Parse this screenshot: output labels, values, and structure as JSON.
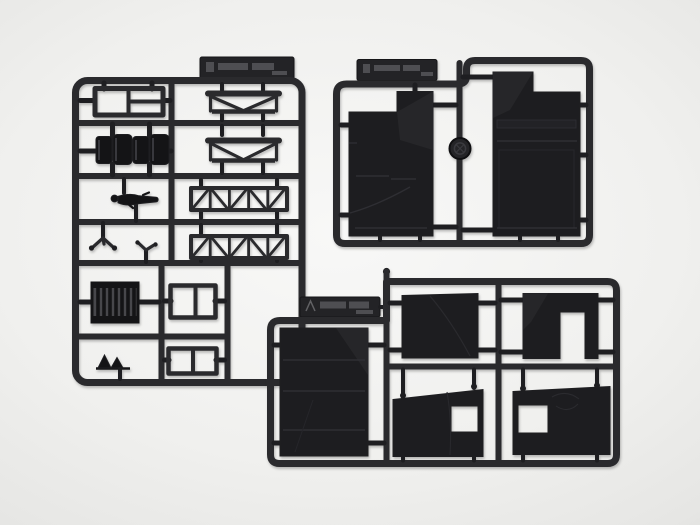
{
  "scene": {
    "alt": "Photograph of three black injection-molded plastic model kit sprues (part trees) laid on a light gray studio background",
    "background": "light gray seamless backdrop, soft vignette"
  },
  "colors": {
    "bg_center": "#f8f8f7",
    "bg_mid": "#f0f0ee",
    "bg_outer": "#e6e6e4",
    "bg_corner": "#dededc",
    "runner": "#2a2a2d",
    "runner_dark": "#1e1e21",
    "plastic": "#1d1d20",
    "plastic_part": "#141416",
    "plastic_seam": "#313135",
    "slat_gap": "#47474b",
    "tag": "#232326",
    "emboss": "#8a8a8e"
  },
  "sprues": [
    {
      "name": "sprue-a-detail-parts",
      "alt": "Small-parts sprue: three-pane window frame, two bench seats, prone crew figure, two mirror arms, radiator grille, two roof trusses, two X-braced girder trusses, two twin window frames and terrain wedges",
      "tag_note": "molded maker tag, embossed illegible lettering"
    },
    {
      "name": "sprue-b-large-panels",
      "alt": "Sprue with two large flat body side panels, a round hub cap on the center runner and a molded maker tag",
      "tag_note": "molded maker tag, embossed illegible lettering"
    },
    {
      "name": "sprue-c-wall-panels",
      "alt": "Sprue with a large wall panel, a plain rectangular panel, an inverted-U shaped panel with doorway, and two trapezoid wall panels with rectangular window openings",
      "tag_note": "molded maker tag with caret mark, embossed illegible lettering"
    }
  ]
}
